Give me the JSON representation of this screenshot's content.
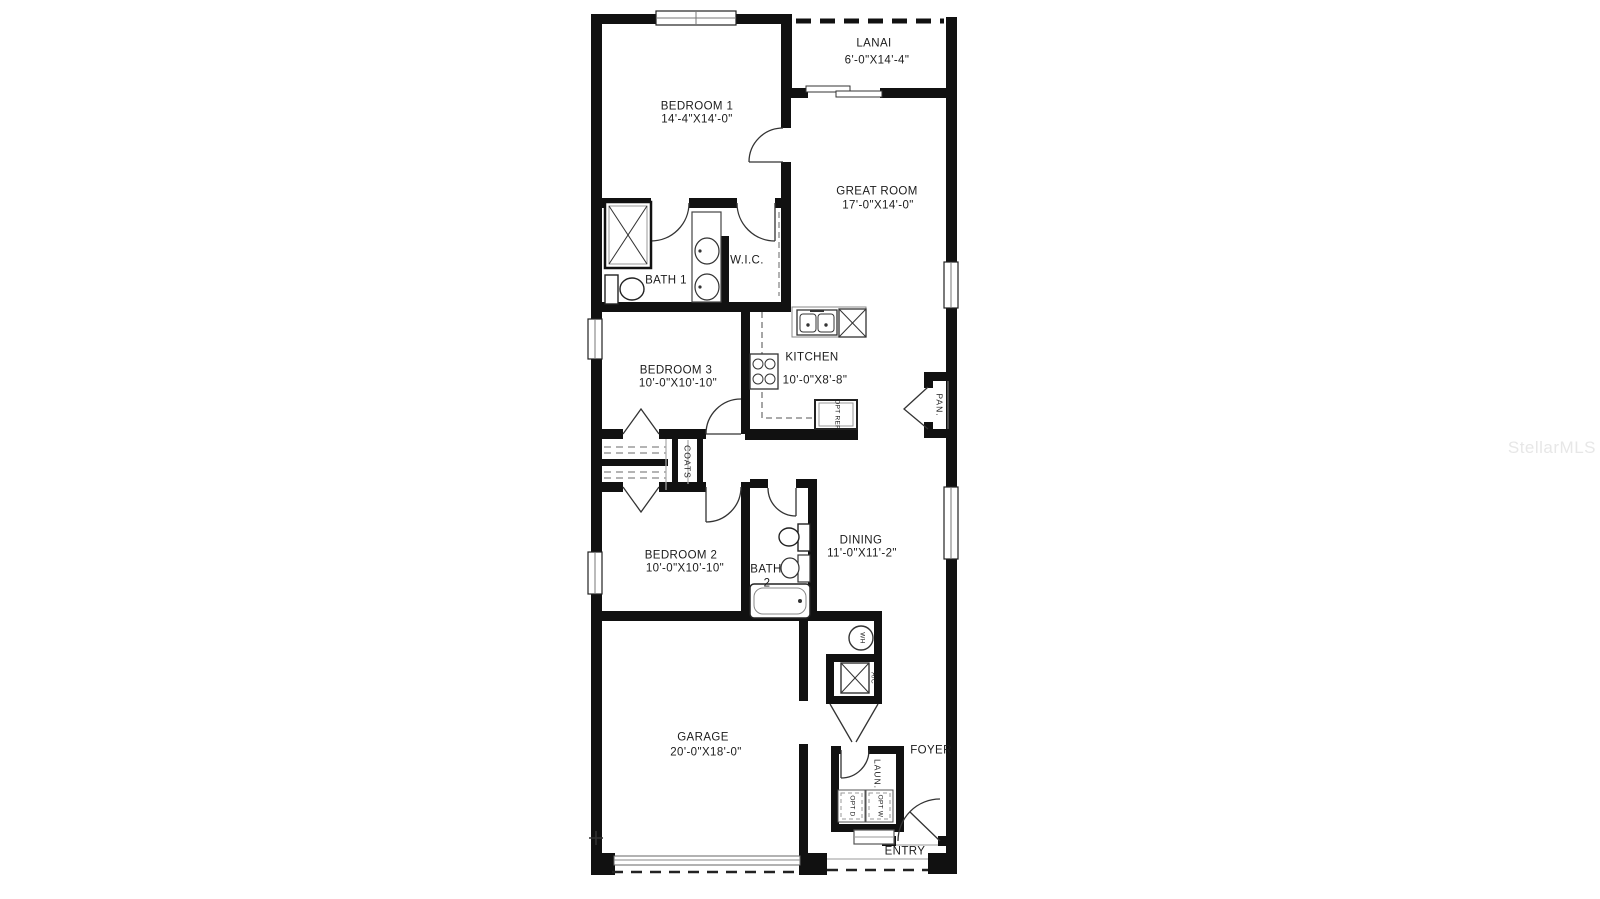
{
  "watermark": "StellarMLS",
  "rooms": {
    "bedroom1": {
      "name": "BEDROOM 1",
      "dims": "14'-4\"X14'-0\""
    },
    "lanai": {
      "name": "LANAI",
      "dims": "6'-0\"X14'-4\""
    },
    "great_room": {
      "name": "GREAT ROOM",
      "dims": "17'-0\"X14'-0\""
    },
    "bath1": {
      "name": "BATH 1"
    },
    "wic": {
      "name": "W.I.C."
    },
    "bedroom3": {
      "name": "BEDROOM 3",
      "dims": "10'-0\"X10'-10\""
    },
    "kitchen": {
      "name": "KITCHEN",
      "dims": "10'-0\"X8'-8\""
    },
    "pantry": {
      "name": "PAN."
    },
    "coats": {
      "name": "COATS"
    },
    "bedroom2": {
      "name": "BEDROOM 2",
      "dims": "10'-0\"X10'-10\""
    },
    "bath2": {
      "name": "BATH",
      "number": "2"
    },
    "dining": {
      "name": "DINING",
      "dims": "11'-0\"X11'-2\""
    },
    "garage": {
      "name": "GARAGE",
      "dims": "20'-0\"X18'-0\""
    },
    "foyer": {
      "name": "FOYER"
    },
    "laundry": {
      "name": "LAUN."
    },
    "entry": {
      "name": "ENTRY"
    }
  },
  "fixtures": {
    "water_heater": "WH",
    "ac_unit": "A/C",
    "optional_refrigerator": "OPT REF.",
    "optional_dryer": "OPT D",
    "optional_washer": "OPT W"
  },
  "colors": {
    "wall": "#111111",
    "line": "#444444",
    "watermark": "#e7e7e7"
  }
}
